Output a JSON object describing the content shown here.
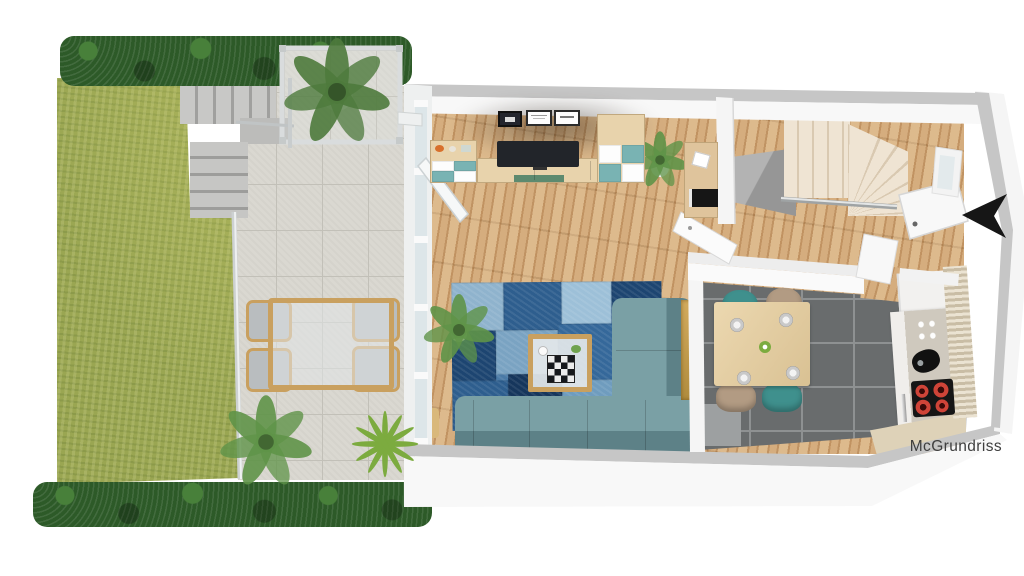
{
  "watermark": {
    "text": "McGrundriss"
  },
  "colors": {
    "background": "#ffffff",
    "lawn": "#9aa652",
    "hedge": "#2d5a28",
    "hedge_light": "#48803a",
    "terrace_tile": "#dad8d1",
    "terrace_grout": "#c2c0b8",
    "step_concrete": "#b5b5b3",
    "wall_top": "#c6c6c6",
    "wall_face": "#f8f8f8",
    "wood": "#cfa473",
    "rug_base": "#4a7aa6",
    "rug_1": "#8fb3cd",
    "rug_2": "#2e5e8e",
    "rug_3": "#9dc0d8",
    "rug_4": "#1d4571",
    "rug_5": "#7aa3c2",
    "rug_6": "#35689a",
    "rug_7": "#16365c",
    "rug_8": "#6f9cbe",
    "rug_9": "#24507e",
    "sofa": "#7aa0a5",
    "sofa_dark": "#5d8187",
    "table_wood": "#c9a05f",
    "cabinet_wood": "#e8d3ac",
    "cabinet_teal": "#79b3b3",
    "cabinet_white": "#fdfdfd",
    "tv": "#22252a",
    "stair": "#efe4d3",
    "stair_dark": "#d9c9b1",
    "kitchen_tile": "#696c6d",
    "kitchen_grout": "#8e9192",
    "dining_table": "#e5d0a9",
    "chair_teal": "#3f908d",
    "chair_beige": "#b29b83",
    "stove": "#161616",
    "blind_light": "#ebe3d2",
    "blind_dark": "#c9bda5",
    "gold": "#c8a158",
    "arrow": "#161616",
    "plant_dark": "#4e7a3c",
    "plant_mid": "#5f9448",
    "plant_bright": "#7cab3f",
    "pot": "#f0f0f0",
    "watermark": "#3e3e3e"
  }
}
